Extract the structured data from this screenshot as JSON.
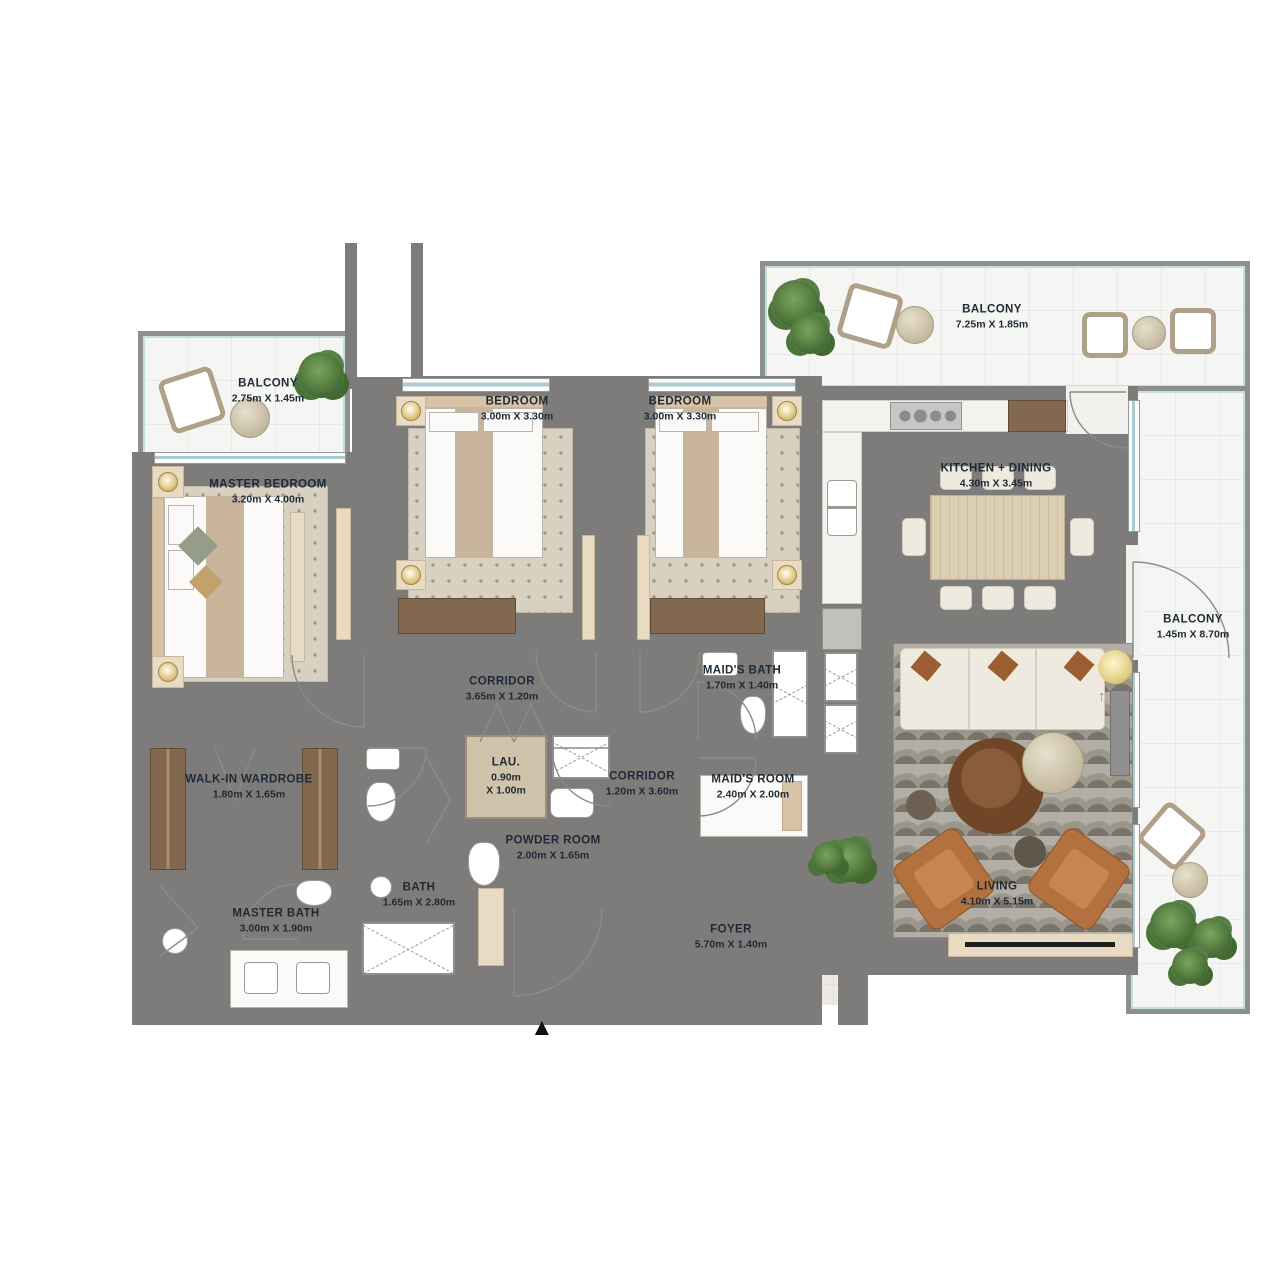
{
  "plan": {
    "rooms": {
      "balcony_top_left": {
        "name": "BALCONY",
        "dims": "2.75m X 1.45m"
      },
      "master_bedroom": {
        "name": "MASTER BEDROOM",
        "dims": "3.20m X 4.00m"
      },
      "bedroom_1": {
        "name": "BEDROOM",
        "dims": "3.00m X 3.30m"
      },
      "bedroom_2": {
        "name": "BEDROOM",
        "dims": "3.00m X 3.30m"
      },
      "balcony_top": {
        "name": "BALCONY",
        "dims": "7.25m X 1.85m"
      },
      "kitchen_dining": {
        "name": "KITCHEN + DINING",
        "dims": "4.30m X 3.45m"
      },
      "balcony_right": {
        "name": "BALCONY",
        "dims": "1.45m X 8.70m"
      },
      "corridor_1": {
        "name": "CORRIDOR",
        "dims": "3.65m X 1.20m"
      },
      "maids_bath": {
        "name": "MAID'S BATH",
        "dims": "1.70m X 1.40m"
      },
      "laundry": {
        "name": "LAU.",
        "d1": "0.90m",
        "d2": "X 1.00m"
      },
      "corridor_2": {
        "name": "CORRIDOR",
        "dims": "1.20m X 3.60m"
      },
      "maids_room": {
        "name": "MAID'S ROOM",
        "dims": "2.40m X 2.00m"
      },
      "walk_in_wardrobe": {
        "name": "WALK-IN WARDROBE",
        "dims": "1.80m X 1.65m"
      },
      "powder_room": {
        "name": "POWDER ROOM",
        "dims": "2.00m X 1.65m"
      },
      "bath": {
        "name": "BATH",
        "dims": "1.65m X 2.80m"
      },
      "master_bath": {
        "name": "MASTER BATH",
        "dims": "3.00m X 1.90m"
      },
      "living": {
        "name": "LIVING",
        "dims": "4.10m X 5.15m"
      },
      "foyer": {
        "name": "FOYER",
        "dims": "5.70m X 1.40m"
      }
    },
    "icons": {
      "entry_marker": "▲",
      "arrow_left": "←",
      "arrow_up": "↑",
      "arrow_down": "↓"
    },
    "colors": {
      "wall": "#7d7c7b",
      "floor": "#edeae5",
      "balcony_floor": "#f5f5f3",
      "window_glass": "#a9ccd3",
      "wood": "#81684f",
      "label_text": "#1d2a36"
    }
  }
}
